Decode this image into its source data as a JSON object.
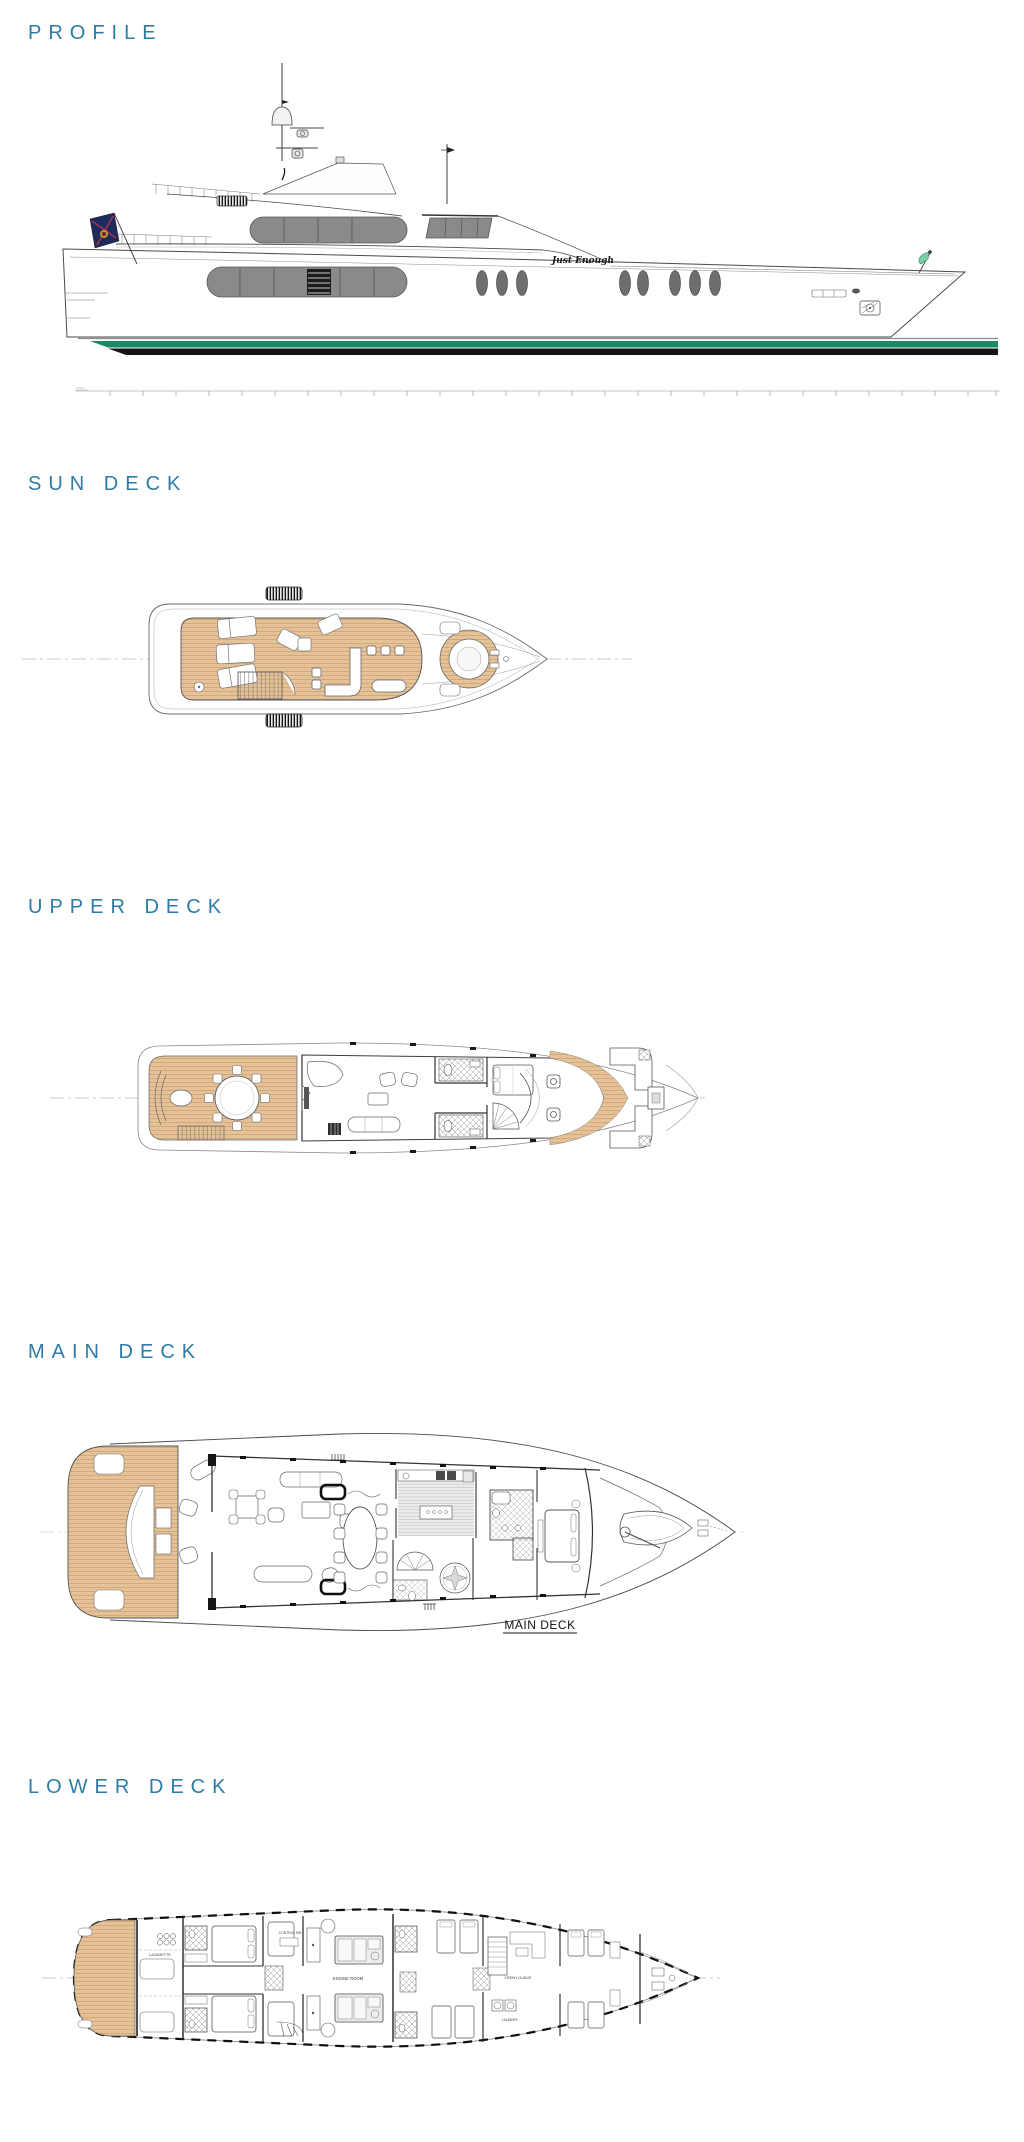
{
  "colors": {
    "heading_blue": "#2e7ba9",
    "teak_wood": "#e6c298",
    "boot_stripe_green": "#1b8a63",
    "antifouling_black": "#141414",
    "window_gray": "#8a8a8a"
  },
  "sections": {
    "profile": {
      "heading": "PROFILE",
      "yacht_name": "Just Enough"
    },
    "sun_deck": {
      "heading": "SUN DECK"
    },
    "upper_deck": {
      "heading": "UPPER DECK"
    },
    "main_deck": {
      "heading": "MAIN DECK",
      "caption": "MAIN DECK"
    },
    "lower_deck": {
      "heading": "LOWER DECK",
      "room_labels": {
        "lazarette": "LAZARETTE",
        "control_room": "CONTROL RM",
        "engine_room": "ENGINE ROOM",
        "crew_lounge": "CREW LOUNGE",
        "laundry": "LAUNDRY"
      }
    }
  }
}
